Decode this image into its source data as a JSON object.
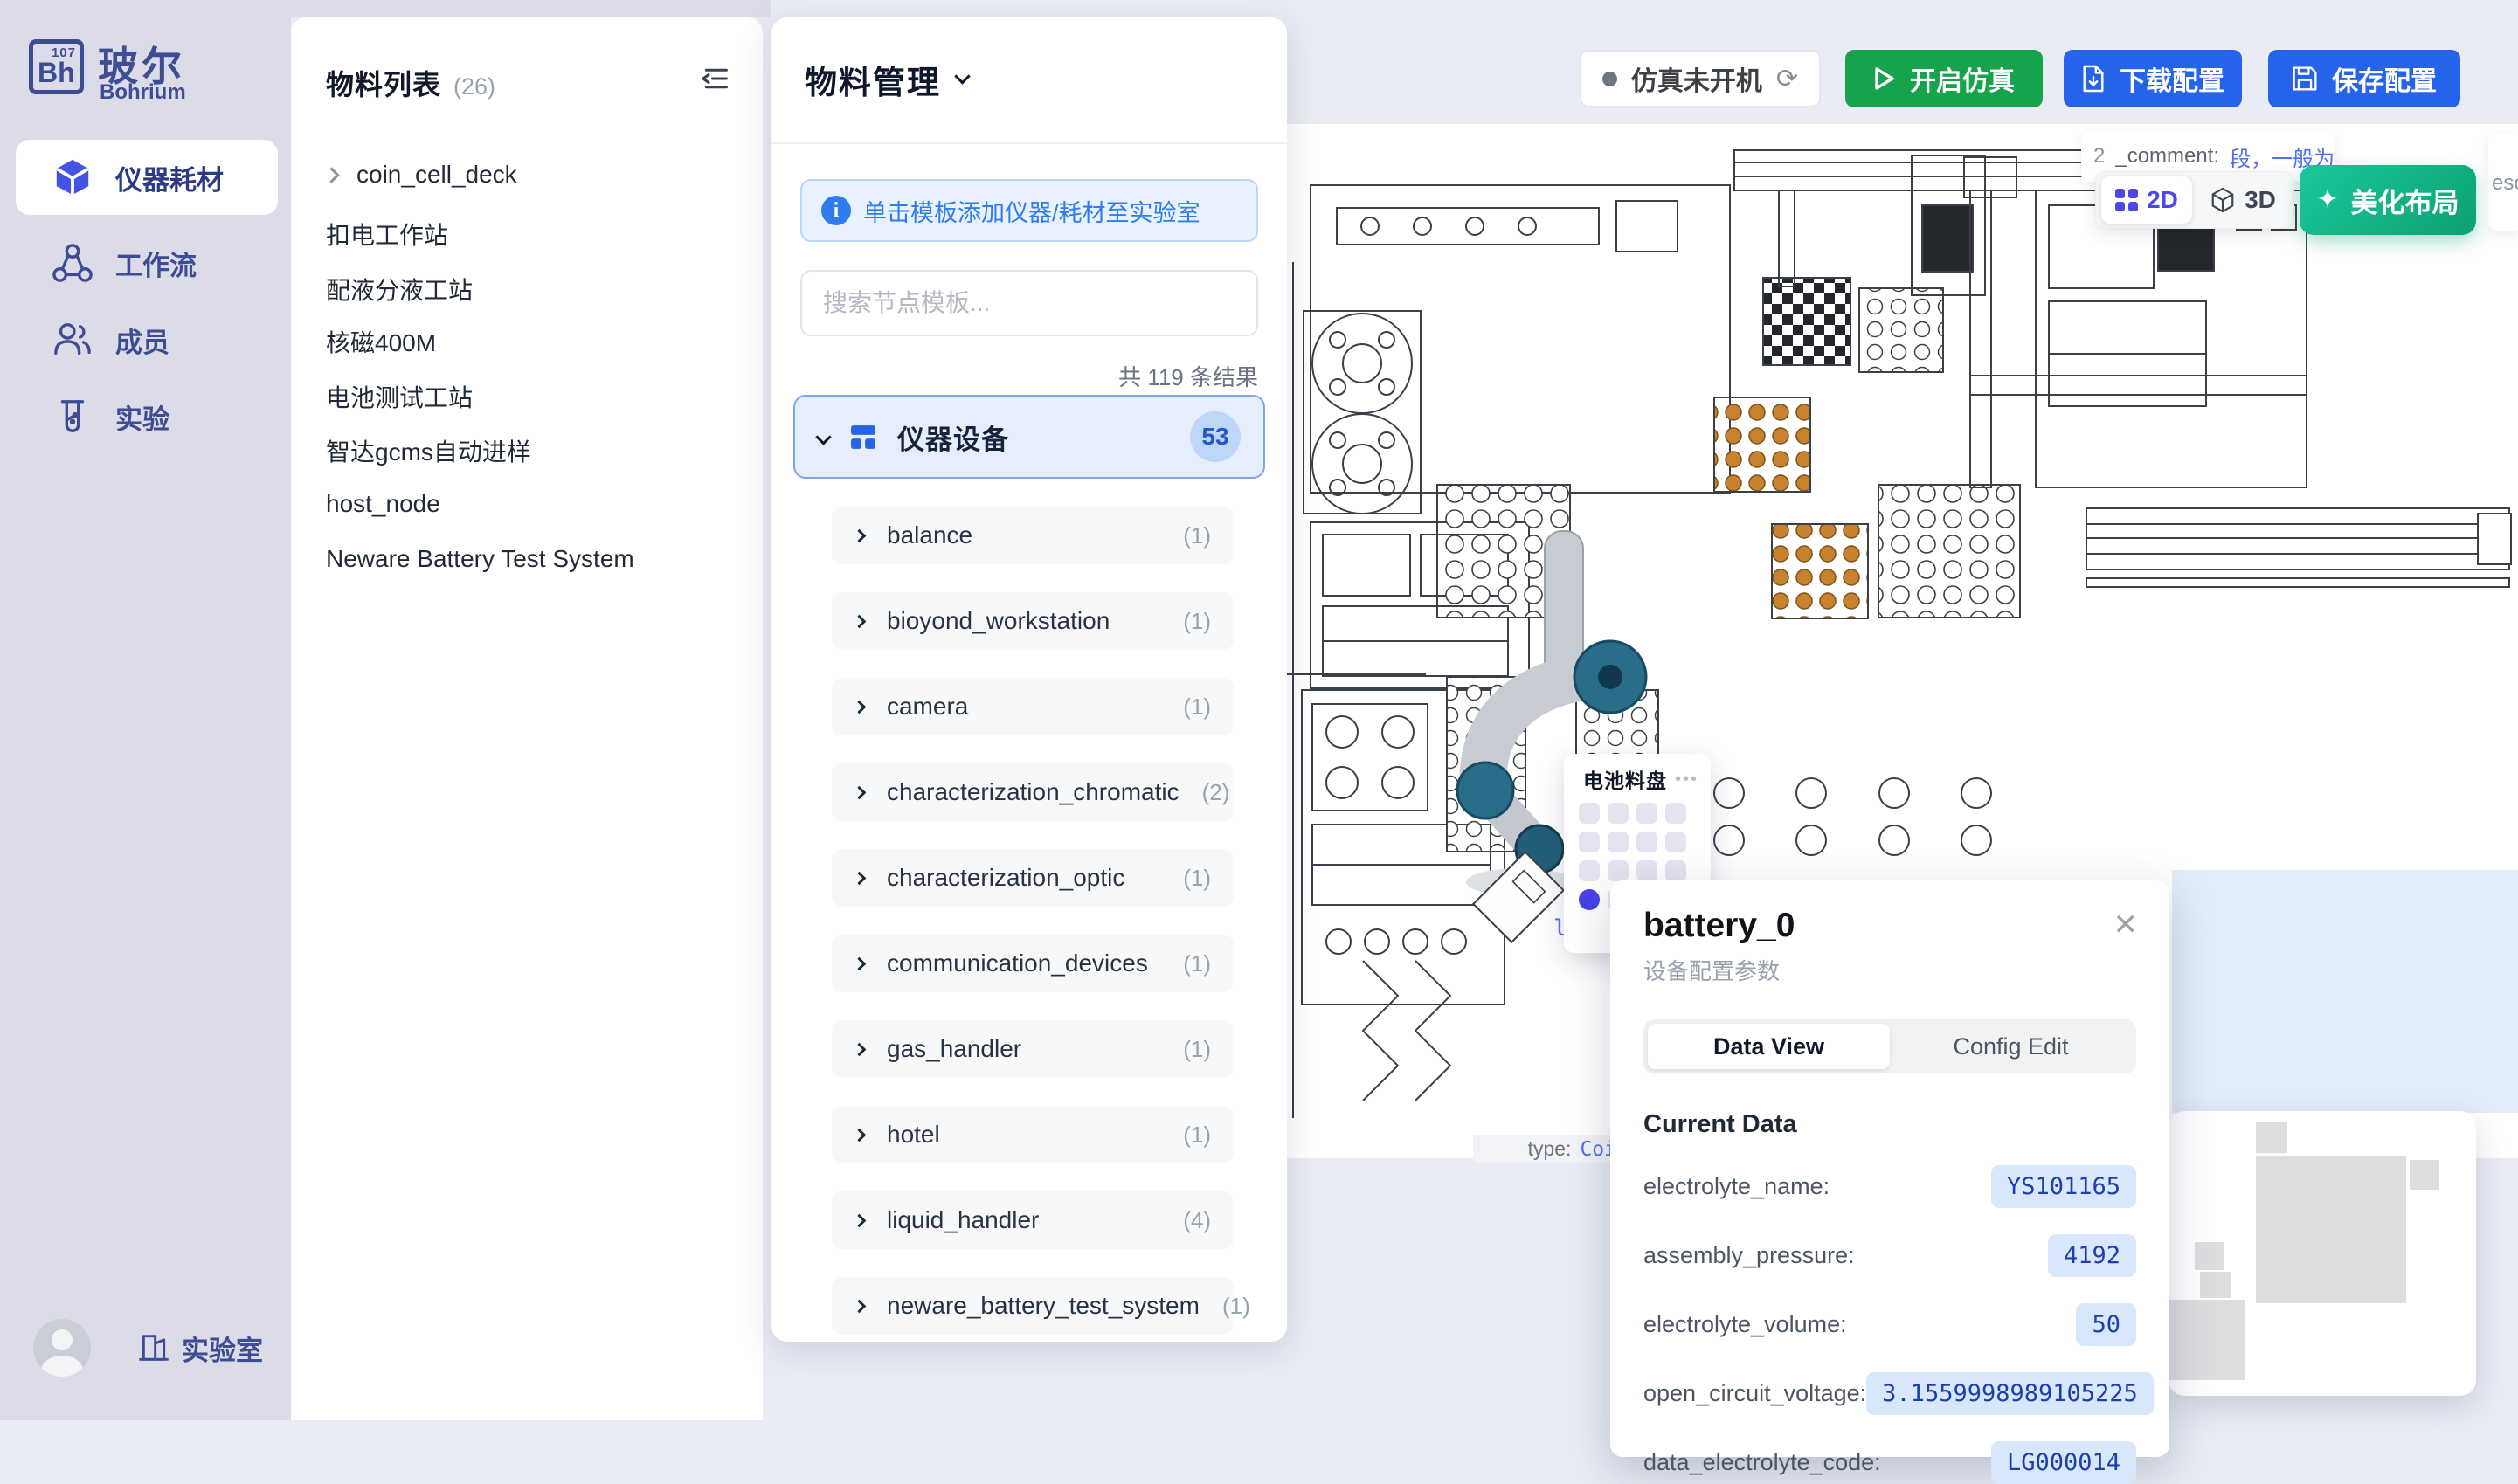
{
  "app": {
    "brand_symbol": "Bh",
    "brand_number": "107",
    "brand_name": "玻尔",
    "brand_sub": "Bohrium"
  },
  "sidebar": {
    "items": [
      {
        "label": "仪器耗材"
      },
      {
        "label": "工作流"
      },
      {
        "label": "成员"
      },
      {
        "label": "实验"
      }
    ],
    "bottom_label": "实验室"
  },
  "materials": {
    "title": "物料列表",
    "count": "(26)",
    "items": [
      "coin_cell_deck",
      "扣电工作站",
      "配液分液工站",
      "核磁400M",
      "电池测试工站",
      "智达gcms自动进样",
      "host_node",
      "Neware Battery Test System"
    ]
  },
  "manage": {
    "title": "物料管理",
    "banner": "单击模板添加仪器/耗材至实验室",
    "search_placeholder": "搜索节点模板...",
    "result_count": "共 119 条结果",
    "category": {
      "name": "仪器设备",
      "badge": "53"
    },
    "items": [
      {
        "name": "balance",
        "count": "(1)"
      },
      {
        "name": "bioyond_workstation",
        "count": "(1)"
      },
      {
        "name": "camera",
        "count": "(1)"
      },
      {
        "name": "characterization_chromatic",
        "count": "(2)"
      },
      {
        "name": "characterization_optic",
        "count": "(1)"
      },
      {
        "name": "communication_devices",
        "count": "(1)"
      },
      {
        "name": "gas_handler",
        "count": "(1)"
      },
      {
        "name": "hotel",
        "count": "(1)"
      },
      {
        "name": "liquid_handler",
        "count": "(4)"
      },
      {
        "name": "neware_battery_test_system",
        "count": "(1)"
      }
    ]
  },
  "toolbar": {
    "status": "仿真未开机",
    "refresh_icon": "⟳",
    "start": "开启仿真",
    "download": "下载配置",
    "save": "保存配置"
  },
  "canvas": {
    "toggle_2d": "2D",
    "toggle_3d": "3D",
    "beautify": "美化布局",
    "sparkle": "✦",
    "tooltip_prefix": "2",
    "tooltip_key": "_comment:",
    "tooltip_value": "段，一般为空，stat",
    "fragment_right": "esou",
    "fragment_plate": "late",
    "type_label": "type:",
    "type_value": "Coi"
  },
  "tray": {
    "title": "电池料盘",
    "menu": "•••",
    "rows": 4,
    "cols": 4,
    "selected_index": 12
  },
  "popup": {
    "title": "battery_0",
    "subtitle": "设备配置参数",
    "close": "✕",
    "tabs": [
      "Data View",
      "Config Edit"
    ],
    "active_tab": "Data View",
    "section": "Current Data",
    "rows": [
      {
        "label": "electrolyte_name:",
        "value": "YS101165"
      },
      {
        "label": "assembly_pressure:",
        "value": "4192"
      },
      {
        "label": "electrolyte_volume:",
        "value": "50"
      },
      {
        "label": "open_circuit_voltage:",
        "value": "3.1559998989105225"
      },
      {
        "label": "data_electrolyte_code:",
        "value": "LG000014"
      }
    ]
  },
  "colors": {
    "accent_blue": "#2663eb",
    "accent_green": "#17a34c",
    "beautify_green": "#10b583",
    "sidebar_bg": "#dbdce8",
    "sidebar_text": "#3d4c93",
    "value_pill_bg": "#d9e7fc",
    "value_pill_text": "#1d3fae",
    "selected_cell": "#4742e9"
  }
}
